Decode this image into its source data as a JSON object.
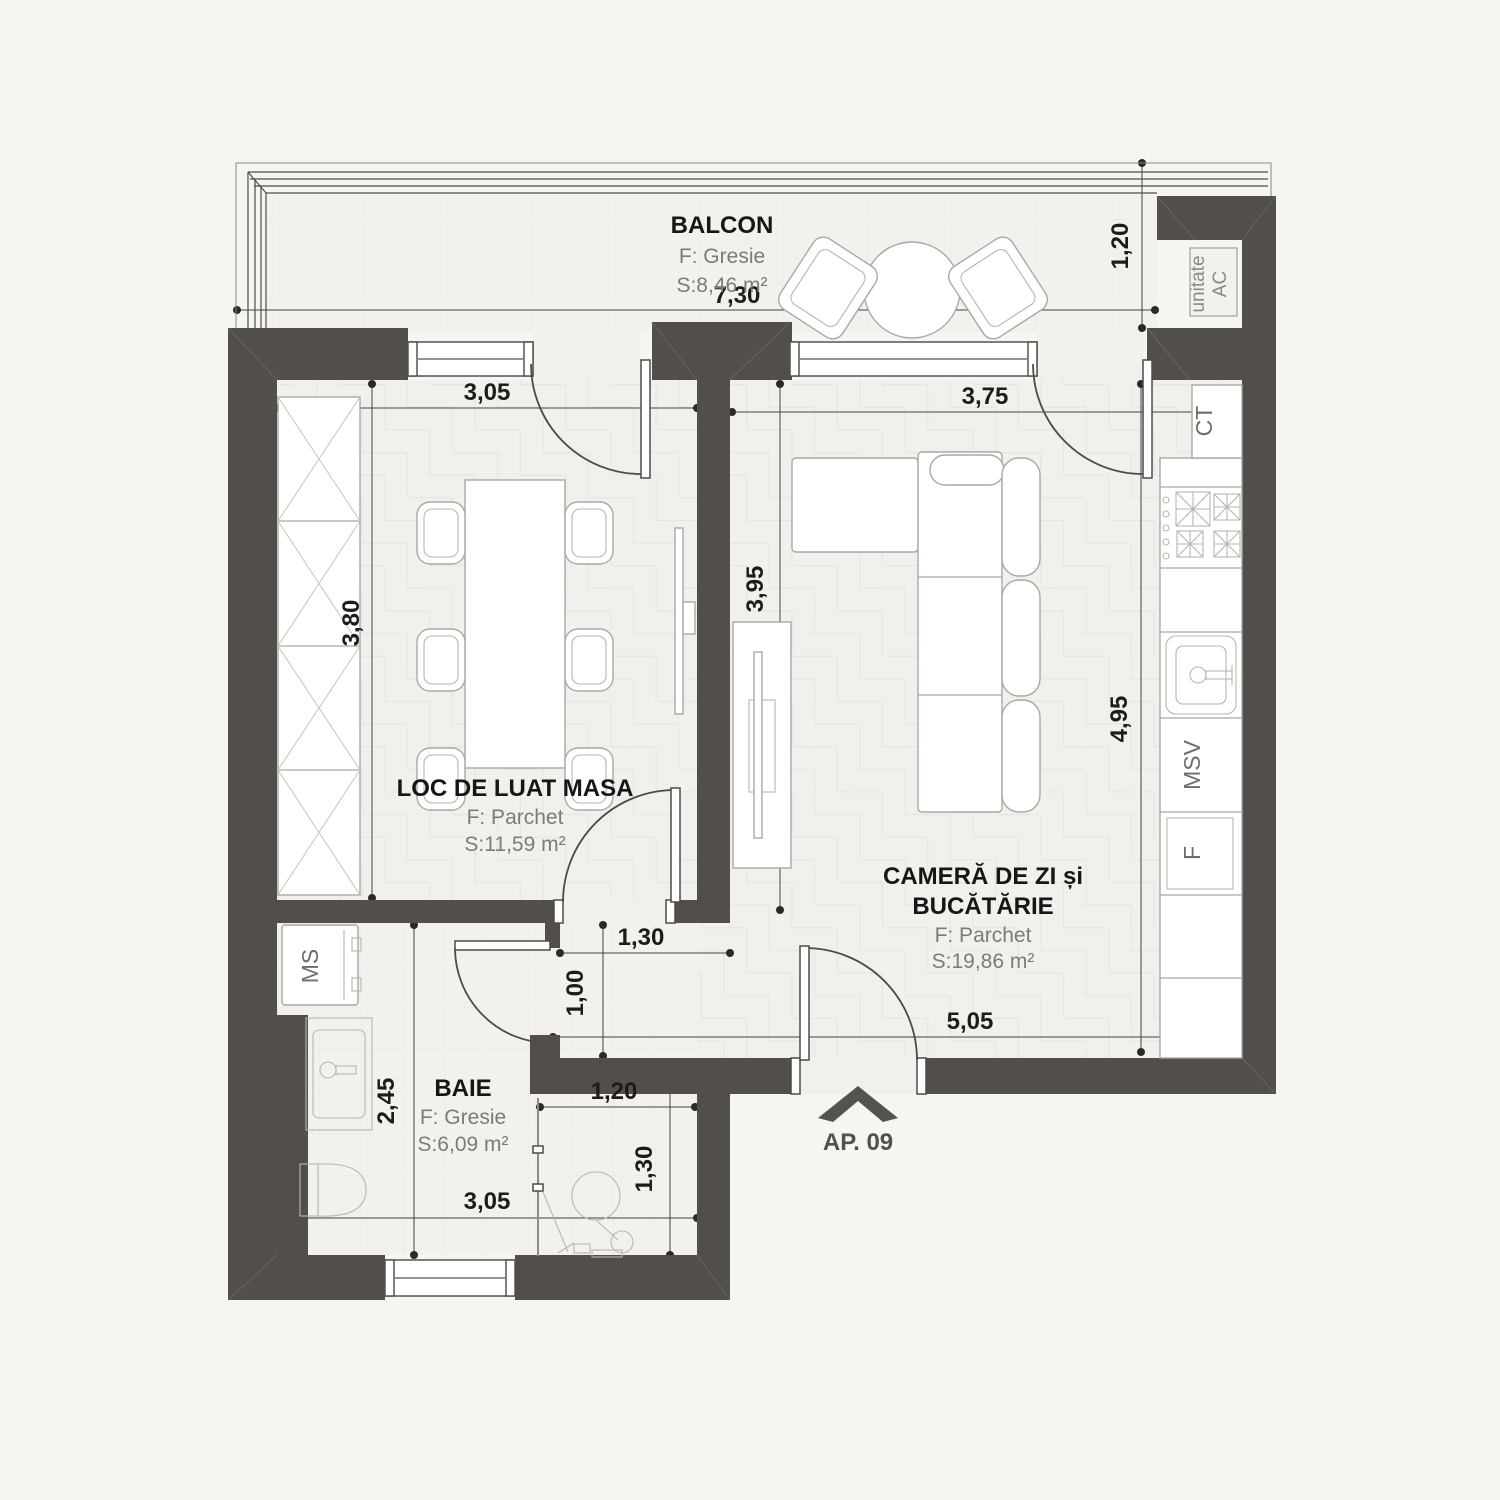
{
  "plan": {
    "apartment_label": "AP. 09",
    "rooms": {
      "balcony": {
        "name": "BALCON",
        "floor": "F: Gresie",
        "area": "S:8,46 m²"
      },
      "dining": {
        "name": "LOC DE LUAT MASA",
        "floor": "F: Parchet",
        "area": "S:11,59 m²"
      },
      "living": {
        "name_line1": "CAMERĂ DE ZI și",
        "name_line2": "BUCĂTĂRIE",
        "floor": "F: Parchet",
        "area": "S:19,86 m²"
      },
      "bath": {
        "name": "BAIE",
        "floor": "F: Gresie",
        "area": "S:6,09 m²"
      }
    },
    "fixtures": {
      "ac_unit_line1": "unitate",
      "ac_unit_line2": "AC",
      "boiler": "CT",
      "dishwasher": "MSV",
      "fridge": "F",
      "washing_machine": "MS"
    },
    "dimensions": {
      "balcony_width": "7,30",
      "balcony_depth": "1,20",
      "dining_width": "3,05",
      "dining_depth": "3,80",
      "living_width": "3,75",
      "living_depth_left": "3,95",
      "living_depth_right": "4,95",
      "hall_width": "1,30",
      "hall_depth": "1,00",
      "living_bottom_width": "5,05",
      "bath_depth": "2,45",
      "shower_width": "1,20",
      "shower_depth": "1,30",
      "bath_width": "3,05"
    },
    "colors": {
      "wall": "#524f4b",
      "floor": "#f1f0ed",
      "background": "#f5f5f2"
    }
  }
}
